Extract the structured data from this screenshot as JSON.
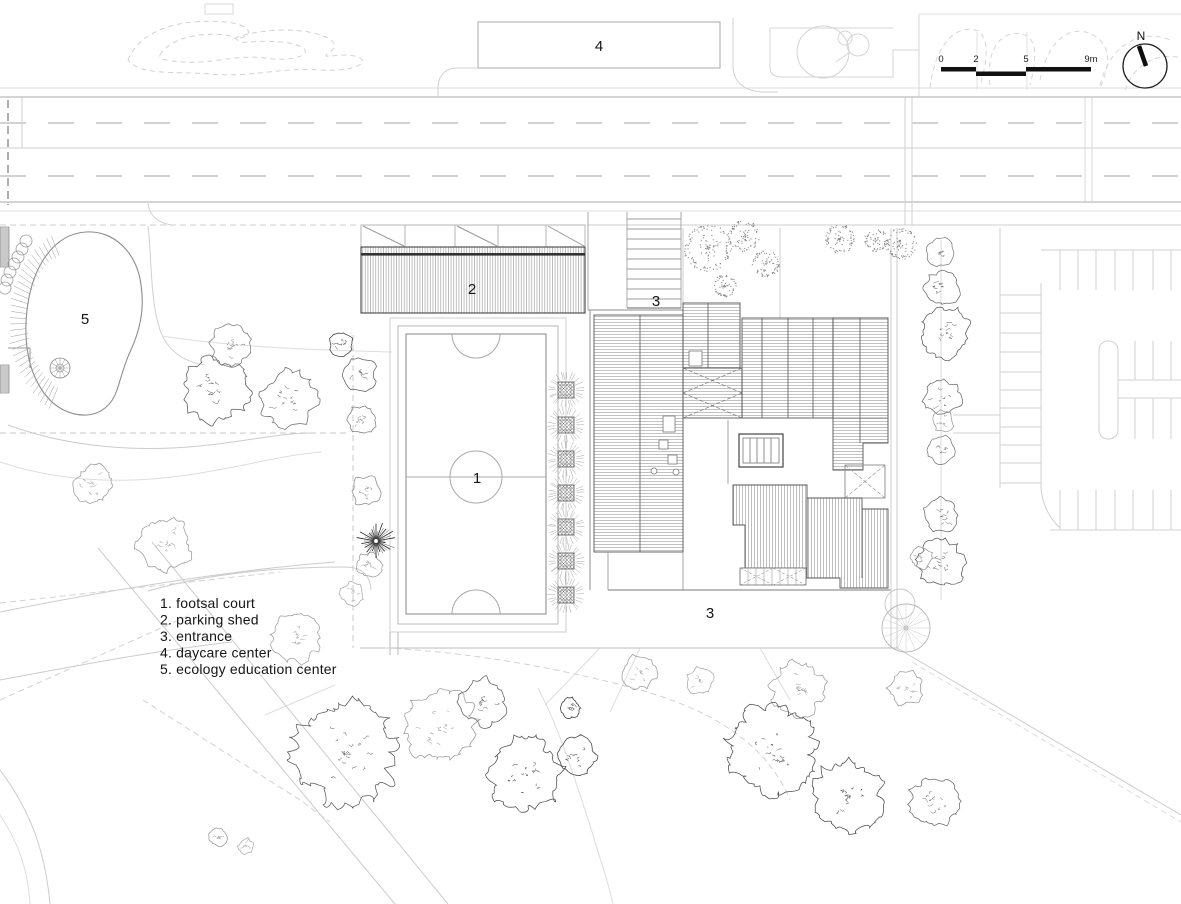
{
  "title": "architectural site plan",
  "colors": {
    "background": "#ffffff",
    "ink": "#1a1a1a",
    "line_gray": "#999999",
    "line_light": "#cccccc",
    "hatch_gray": "#8f8f8f"
  },
  "north_label": "N",
  "scale_bar": {
    "ticks": [
      "0",
      "2",
      "5",
      "9m"
    ]
  },
  "legend": {
    "items": [
      "1. footsal court",
      "2. parking shed",
      "3. entrance",
      "4. daycare center",
      "5. ecology education center"
    ]
  },
  "plan_labels": [
    {
      "id": "futsal-court",
      "text": "1",
      "x": 477,
      "y": 483
    },
    {
      "id": "parking-shed",
      "text": "2",
      "x": 472,
      "y": 294
    },
    {
      "id": "entrance-top",
      "text": "3",
      "x": 656,
      "y": 306
    },
    {
      "id": "entrance-bottom",
      "text": "3",
      "x": 710,
      "y": 618
    },
    {
      "id": "daycare-center",
      "text": "4",
      "x": 599,
      "y": 51
    },
    {
      "id": "ecology-education-center",
      "text": "5",
      "x": 85,
      "y": 324
    }
  ],
  "trees": {
    "scratchy": [
      [
        215,
        390,
        34,
        "#5a5a5a"
      ],
      [
        289,
        399,
        29,
        "#6a6a6a"
      ],
      [
        231,
        346,
        21,
        "#7a7a7a"
      ],
      [
        341,
        344,
        12,
        "#3a3a3a"
      ],
      [
        360,
        374,
        17,
        "#5f5f5f"
      ],
      [
        362,
        420,
        15,
        "#7d7d7d"
      ],
      [
        366,
        491,
        16,
        "#8a8a8a"
      ],
      [
        370,
        565,
        13,
        "#9a9a9a"
      ],
      [
        352,
        594,
        12,
        "#ababab"
      ],
      [
        93,
        485,
        21,
        "#9a9a9a"
      ],
      [
        165,
        545,
        28,
        "#999999"
      ],
      [
        296,
        638,
        26,
        "#9f9f9f"
      ],
      [
        345,
        752,
        53,
        "#585858"
      ],
      [
        440,
        727,
        38,
        "#9a9a9a"
      ],
      [
        483,
        702,
        24,
        "#606060"
      ],
      [
        525,
        774,
        38,
        "#4a4a4a"
      ],
      [
        570,
        708,
        11,
        "#2e2e2e"
      ],
      [
        577,
        756,
        20,
        "#3c3c3c"
      ],
      [
        640,
        672,
        18,
        "#9c9c9c"
      ],
      [
        700,
        681,
        14,
        "#a8a8a8"
      ],
      [
        798,
        689,
        28,
        "#9c9c9c"
      ],
      [
        770,
        749,
        46,
        "#4c4c4c"
      ],
      [
        847,
        796,
        37,
        "#4a4a4a"
      ],
      [
        906,
        688,
        18,
        "#9a9a9a"
      ],
      [
        934,
        801,
        26,
        "#6a6a6a"
      ],
      [
        940,
        252,
        14,
        "#7a7a7a"
      ],
      [
        942,
        288,
        18,
        "#6a6a6a"
      ],
      [
        945,
        332,
        26,
        "#5a5a5a"
      ],
      [
        942,
        398,
        19,
        "#6a6a6a"
      ],
      [
        943,
        421,
        11,
        "#9a9a9a"
      ],
      [
        942,
        450,
        14,
        "#7a7a7a"
      ],
      [
        940,
        515,
        18,
        "#6a6a6a"
      ],
      [
        940,
        563,
        25,
        "#575757"
      ],
      [
        921,
        558,
        12,
        "#9a9a9a"
      ],
      [
        218,
        837,
        10,
        "#9a9a9a"
      ],
      [
        246,
        846,
        8,
        "#ababab"
      ]
    ],
    "stipple": [
      [
        708,
        248,
        23
      ],
      [
        744,
        236,
        15
      ],
      [
        766,
        264,
        13
      ],
      [
        725,
        286,
        11
      ],
      [
        840,
        239,
        14
      ],
      [
        876,
        240,
        11
      ],
      [
        901,
        244,
        15
      ]
    ],
    "planter_row": {
      "x": 566,
      "ys": [
        390,
        425,
        459,
        493,
        527,
        561,
        595
      ],
      "r": 17
    },
    "shrub_chain": {
      "r": 6,
      "points": [
        [
          26,
          241
        ],
        [
          22,
          249
        ],
        [
          18,
          257
        ],
        [
          14,
          264
        ],
        [
          10,
          272
        ],
        [
          7,
          280
        ],
        [
          5,
          288
        ]
      ]
    },
    "radial_tree": {
      "x": 906,
      "y": 628,
      "r": 24,
      "companion": {
        "x": 900,
        "y": 604,
        "r": 15
      }
    },
    "star_plant": {
      "x": 376,
      "y": 541,
      "r": 20
    }
  }
}
